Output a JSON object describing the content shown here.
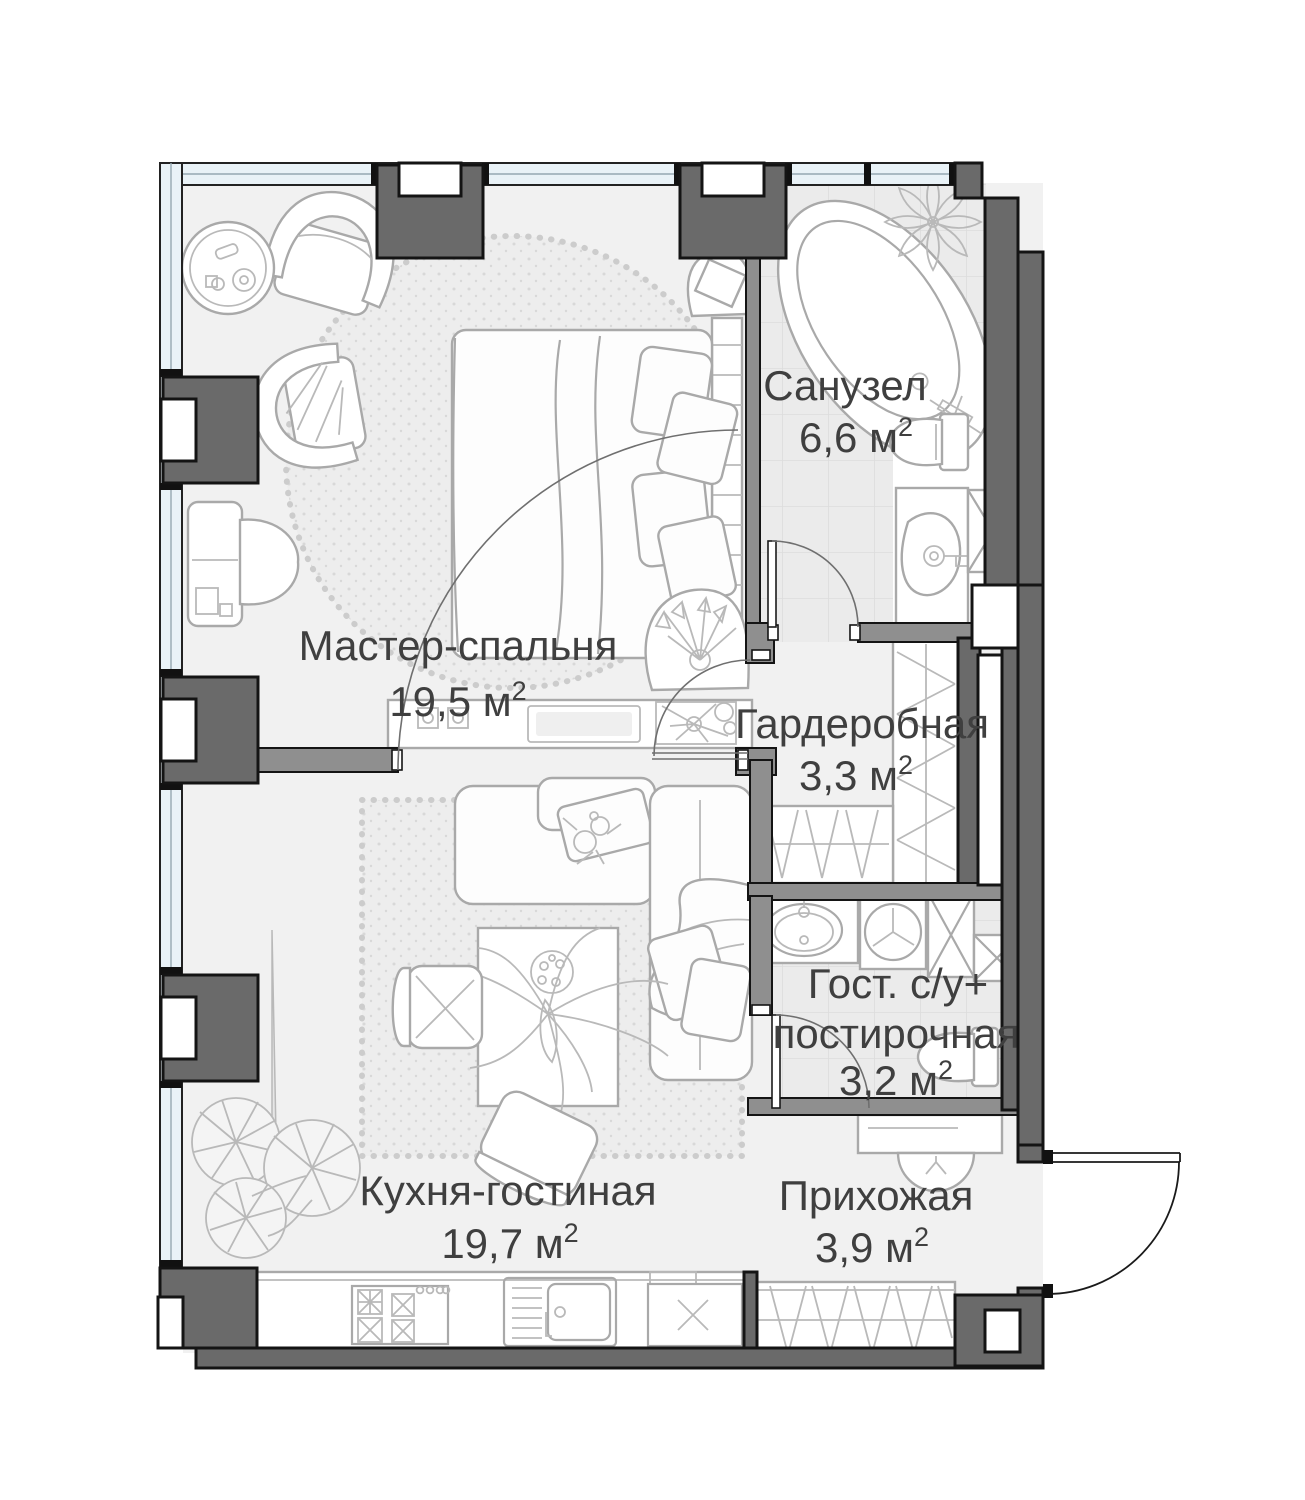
{
  "floor_plan": {
    "type": "apartment_floor_plan",
    "rooms": [
      {
        "id": "master-bedroom",
        "name": "Мастер-спальня",
        "area": "19,5 м",
        "sup": "2"
      },
      {
        "id": "bathroom",
        "name": "Санузел",
        "area": "6,6 м",
        "sup": "2"
      },
      {
        "id": "wardrobe",
        "name": "Гардеробная",
        "area": "3,3 м",
        "sup": "2"
      },
      {
        "id": "guest-wc",
        "name": "Гост. с/у+",
        "name2": "постирочная",
        "area": "3,2 м",
        "sup": "2"
      },
      {
        "id": "kitchen-living",
        "name": "Кухня-гостиная",
        "area": "19,7 м",
        "sup": "2"
      },
      {
        "id": "hallway",
        "name": "Прихожая",
        "area": "3,9 м",
        "sup": "2"
      }
    ],
    "fixtures": [
      "bathtub",
      "toilet",
      "vanity-sink",
      "wash-basin",
      "washing-machine",
      "shower-shaft",
      "kitchen-stove",
      "kitchen-sink",
      "bed",
      "sofa",
      "dining-table",
      "armchair",
      "desk",
      "wardrobe-rails",
      "entry-door",
      "plants"
    ],
    "colors": {
      "wall": "#6a6a6a",
      "partition": "#8f8f8f",
      "window": "#e9f2f7",
      "floor": "#f1f1f1",
      "tile": "#ebebeb",
      "furniture_line": "#a9a9a9",
      "text": "#3f3f3f"
    }
  }
}
